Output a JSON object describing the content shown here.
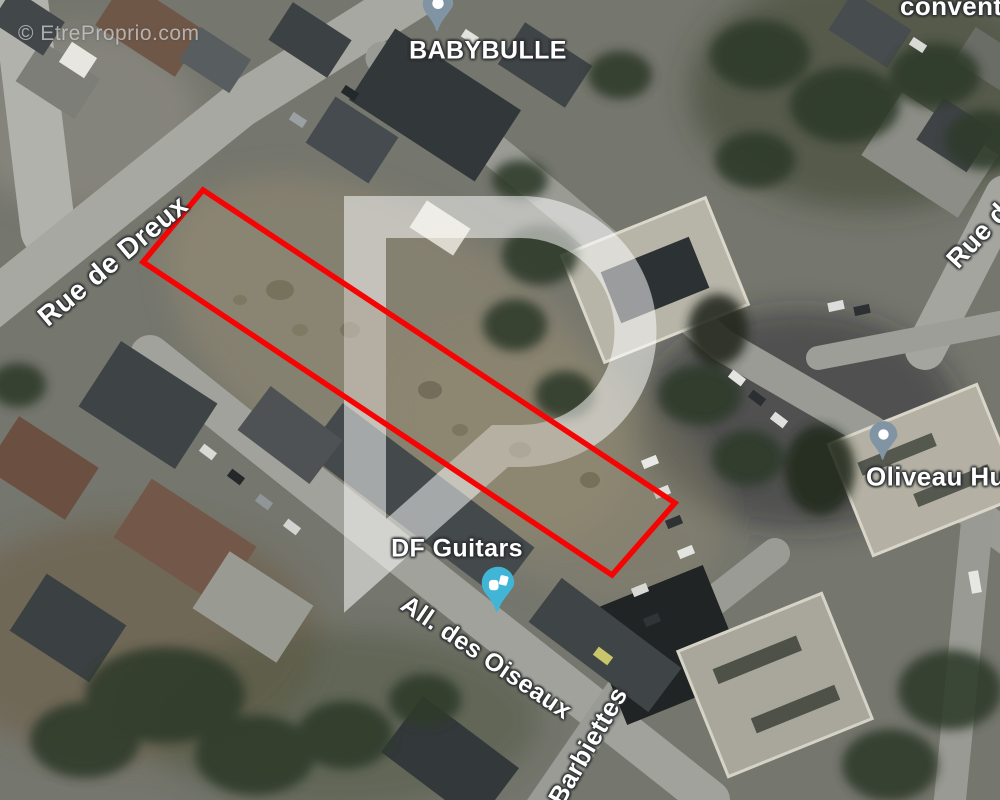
{
  "watermark": {
    "copyright": "© EtreProprio.com",
    "logo_letter": "P"
  },
  "map": {
    "place_labels": [
      {
        "id": "babybulle",
        "name": "BABYBULLE"
      },
      {
        "id": "df-guitars",
        "name": "DF Guitars"
      },
      {
        "id": "oliveau",
        "name": "Oliveau Hugu"
      },
      {
        "id": "convention",
        "name": "conventio"
      }
    ],
    "street_labels": [
      {
        "id": "rue-de-dreux",
        "name": "Rue de Dreux"
      },
      {
        "id": "all-des-oiseaux",
        "name": "All. des Oiseaux"
      },
      {
        "id": "barbiettes",
        "name": "Barbiettes"
      },
      {
        "id": "rue-d",
        "name": "Rue d"
      }
    ],
    "pins": [
      {
        "id": "babybulle-pin",
        "type": "place-pin",
        "color": "#8094a3"
      },
      {
        "id": "oliveau-pin",
        "type": "place-pin",
        "color": "#8094a3"
      },
      {
        "id": "df-guitars-pin",
        "type": "business-pin",
        "color": "#41b5d6"
      }
    ]
  },
  "parcel": {
    "outline_color": "#f60404",
    "corners": [
      [
        203,
        190
      ],
      [
        675,
        503
      ],
      [
        612,
        575
      ],
      [
        143,
        262
      ]
    ]
  },
  "colors": {
    "watermark_logo": "rgba(255,255,255,0.52)",
    "label_text": "#ffffff"
  }
}
